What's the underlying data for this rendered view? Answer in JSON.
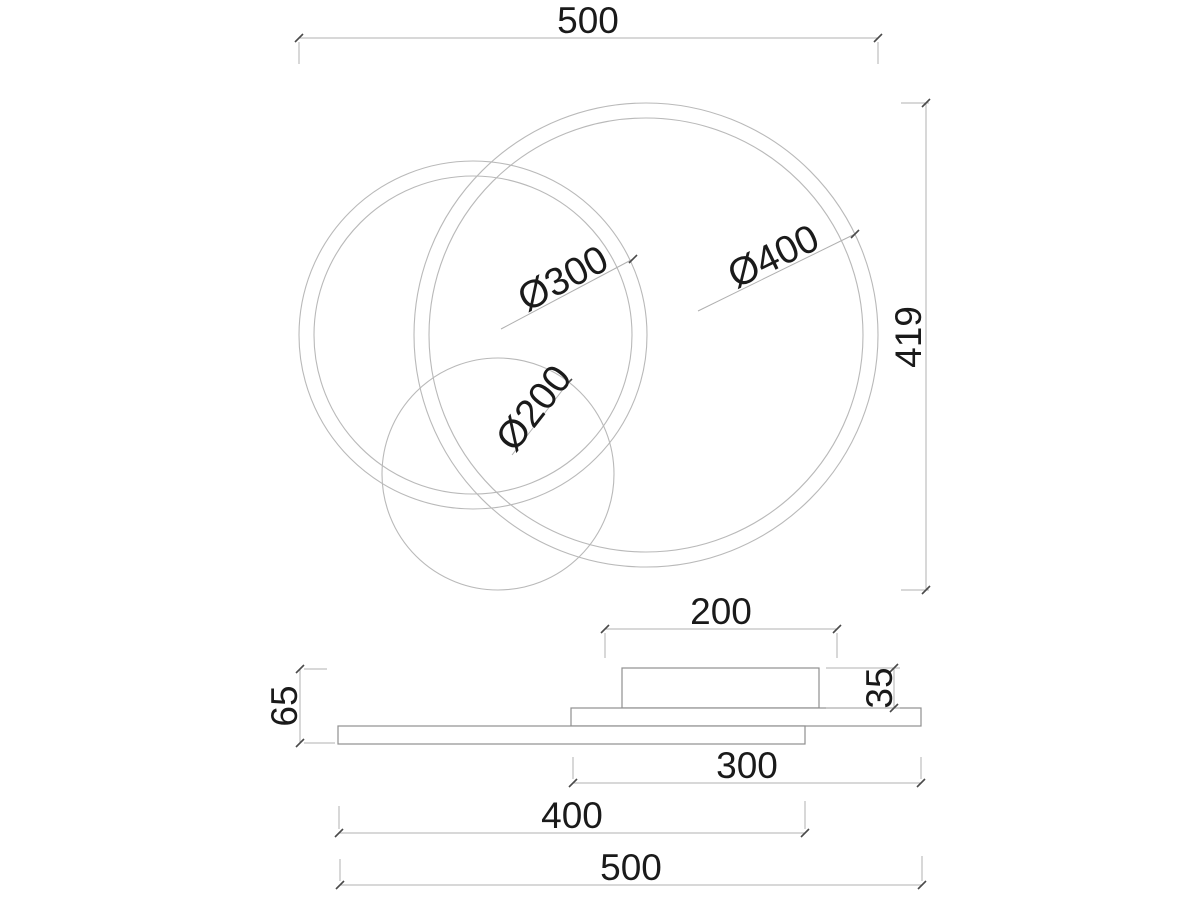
{
  "drawing_type": "lamp dimension drawing",
  "top_view": {
    "width_label": "500",
    "height_label": "419",
    "ring_large_label": "Ø400",
    "ring_medium_label": "Ø300",
    "ring_small_label": "Ø200"
  },
  "side_view": {
    "canopy_width_label": "200",
    "canopy_height_label": "35",
    "overall_height_label": "65",
    "middle_plate_label": "300",
    "bottom_plate_label": "400",
    "overall_width_label": "500"
  },
  "colors": {
    "background": "#ffffff",
    "drawing_line": "#b9b9b9",
    "plate_line": "#8f8f8f",
    "tick": "#4a4a4a",
    "text": "#1a1a1a"
  }
}
